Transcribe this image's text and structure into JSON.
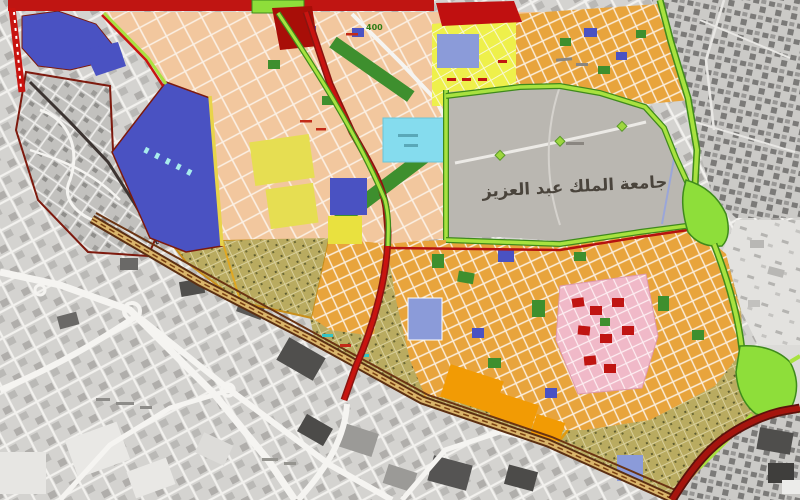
{
  "document": {
    "kind": "city planning / zoning map with surrounding grayscale street fabric"
  },
  "labels": {
    "university": "جامعة الملك عبد العزيز",
    "district_number": "400"
  },
  "colors": {
    "road-red": "#c81410",
    "road-maroon": "#7d1a0e",
    "road-green-fill": "#a8e23f",
    "road-green-casing": "#3f8a1c",
    "road-orange": "#e0911f",
    "road-brown": "#5c2f12",
    "road-tan": "#d9b46a",
    "road-yellow": "#e8d44a",
    "road-white": "#f5f4f1",
    "zone-salmon": "#f2c79e",
    "zone-yellow": "#eef04b",
    "zone-orange": "#e8a43c",
    "zone-orange-bright": "#f29b04",
    "zone-olive": "#b9ab60",
    "zone-pink": "#f0b9c8",
    "zone-blue": "#4a52c2",
    "zone-blue-light": "#8b9bd9",
    "zone-cyan": "#85dcee",
    "zone-green-park": "#3e8f2e",
    "zone-green-bright": "#8ede3a",
    "zone-red-block": "#c01512",
    "zone-university-gray": "#bab7b1",
    "city-gray-base": "#d4d3d0",
    "city-gray-block": "#a9a8a5",
    "city-gray-dark": "#6f6e6c",
    "label-dark": "#4a443c",
    "label-green": "#2f7d16",
    "label-cyan": "#a8ecec"
  },
  "regions": [
    {
      "name": "bottom-left-city-fabric",
      "fill": "city-gray-base"
    },
    {
      "name": "old-town-district",
      "fill": "city-gray-block"
    },
    {
      "name": "top-right-city-fabric",
      "fill": "city-gray-dark"
    },
    {
      "name": "university-campus",
      "fill": "zone-university-gray",
      "label": "جامعة الملك عبد العزيز"
    },
    {
      "name": "planned-salmon-district",
      "fill": "zone-salmon"
    },
    {
      "name": "yellow-district",
      "fill": "zone-yellow"
    },
    {
      "name": "top-orange-district",
      "fill": "zone-orange"
    },
    {
      "name": "orange-residential-belt",
      "fill": "zone-orange"
    },
    {
      "name": "pink-district",
      "fill": "zone-pink"
    },
    {
      "name": "olive-dense-fabric",
      "fill": "zone-olive"
    },
    {
      "name": "blue-reserved-zones",
      "fill": "zone-blue"
    },
    {
      "name": "cyan-facility",
      "fill": "zone-cyan"
    },
    {
      "name": "green-interchanges",
      "fill": "zone-green-bright"
    }
  ]
}
